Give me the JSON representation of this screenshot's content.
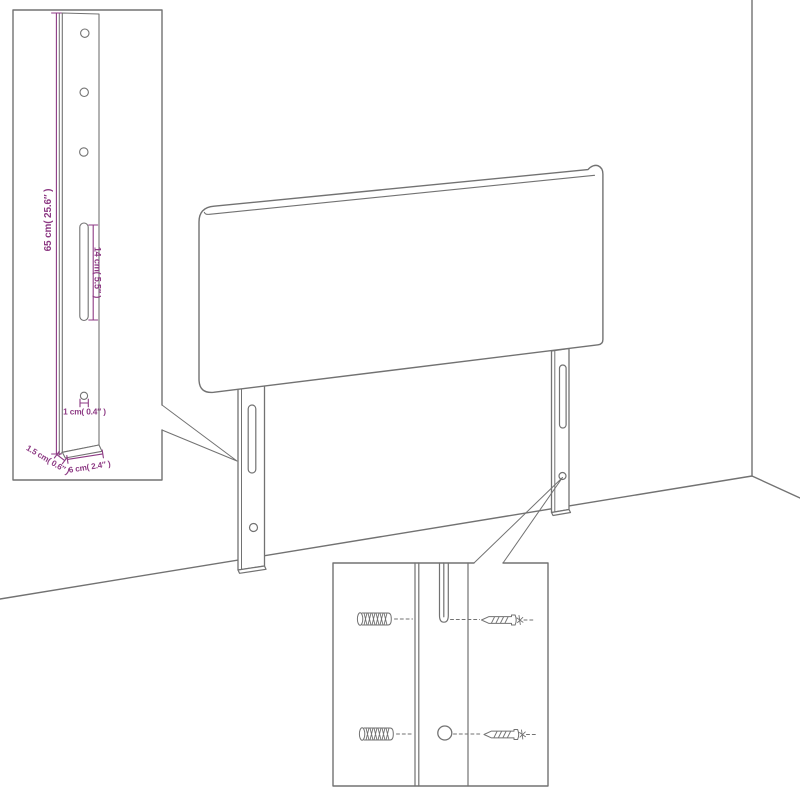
{
  "colors": {
    "background": "#ffffff",
    "line": "#727272",
    "dimension": "#8d3a84"
  },
  "leg_detail_inset": {
    "height_label": "65 cm( 25.6″ )",
    "slot_label": "14 cm( 5.5″ )",
    "hole_label": "1 cm( 0.4″ )",
    "thickness_label": "1.5 cm( 0.6″ )",
    "width_label": "6 cm( 2.4″ )"
  }
}
